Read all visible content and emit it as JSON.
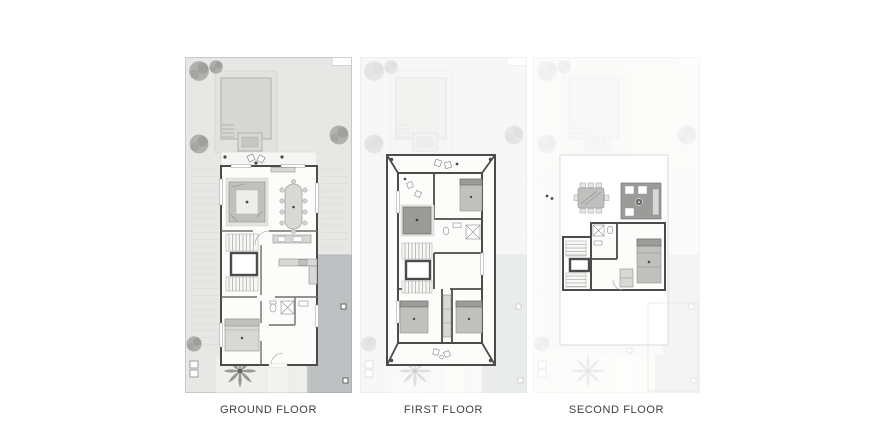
{
  "page": {
    "background": "#ffffff"
  },
  "floorplan": {
    "panels": [
      {
        "id": "ground-floor",
        "label": "GROUND FLOOR"
      },
      {
        "id": "first-floor",
        "label": "FIRST FLOOR"
      },
      {
        "id": "second-floor",
        "label": "SECOND FLOOR"
      }
    ]
  },
  "colors": {
    "page-bg": "#ffffff",
    "label-color": "#3e3e3e",
    "site-fill": "#e7e7e5",
    "site-border": "#c8c8c6",
    "garden-line": "#d8d8d6",
    "pool-fill": "#d8d8d6",
    "pool-border": "#b0b0ae",
    "pool-dot": "#c6c6c4",
    "tree-fill": "#a6a6a4",
    "tree-dark": "#8e8e8c",
    "driveway-fill": "#bdc1c1",
    "driveway-border": "#a9adad",
    "court-fill": "#eeeeec",
    "wall-dark": "#4b4b49",
    "wall-mid": "#6f6f6d",
    "floor-fill": "#fcfcfb",
    "furn-light": "#d8d8d6",
    "furn-mid": "#c0c0be",
    "furn-dark": "#9b9b99",
    "furn-border": "#8f8f8d",
    "ghost-first": "0.3",
    "ghost-second": "0.16"
  }
}
